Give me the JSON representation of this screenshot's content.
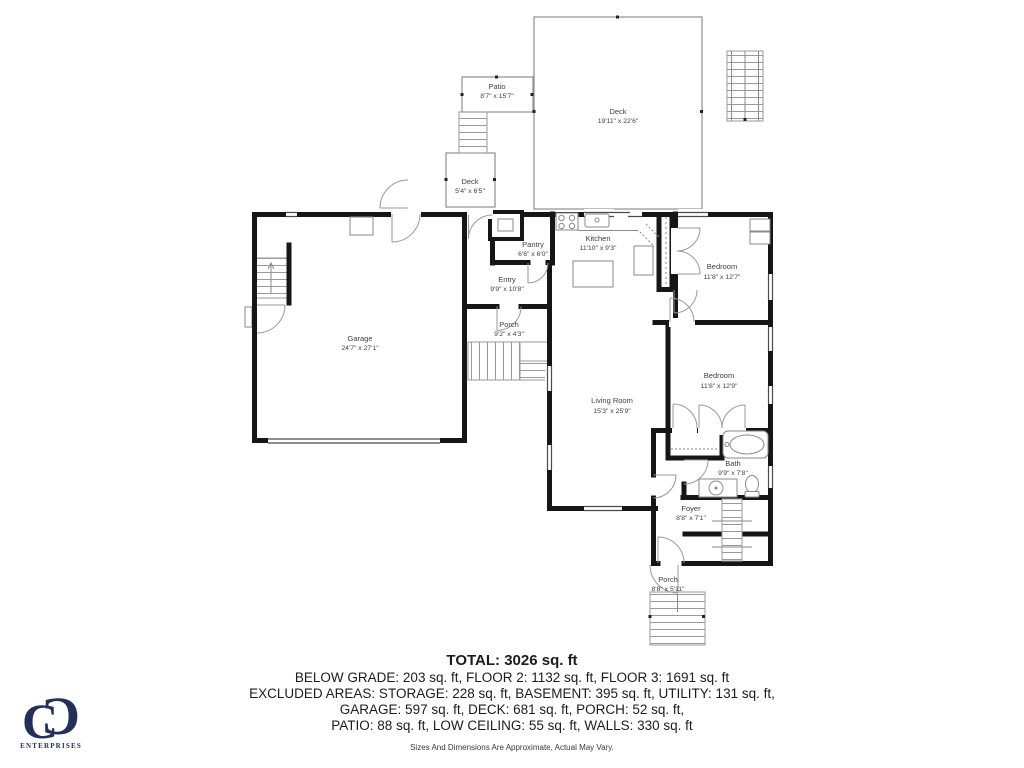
{
  "branding": {
    "monogram_letter": "C",
    "company": "ENTERPRISES",
    "color": "#22305a"
  },
  "floorplan": {
    "wall_color": "#161616",
    "thin_color": "#8f8f8f",
    "label_color": "#3f3f3f",
    "rooms": [
      {
        "name": "Patio",
        "dims": "8'7\" x 15'7\""
      },
      {
        "name": "Deck",
        "dims": "19'11\" x 22'6\""
      },
      {
        "name": "Deck",
        "dims": "5'4\" x 6'5\""
      },
      {
        "name": "Pantry",
        "dims": "6'6\" x 6'0\""
      },
      {
        "name": "Kitchen",
        "dims": "11'10\" x 9'3\""
      },
      {
        "name": "Entry",
        "dims": "9'9\" x 10'8\""
      },
      {
        "name": "Porch",
        "dims": "9'2\" x 4'3\""
      },
      {
        "name": "Garage",
        "dims": "24'7\" x 27'1\""
      },
      {
        "name": "Bedroom",
        "dims": "11'8\" x 12'7\""
      },
      {
        "name": "Bedroom",
        "dims": "11'8\" x 12'9\""
      },
      {
        "name": "Living Room",
        "dims": "15'3\" x 25'9\""
      },
      {
        "name": "Bath",
        "dims": "9'9\" x 7'8\""
      },
      {
        "name": "Foyer",
        "dims": "8'8\" x 7'1\""
      },
      {
        "name": "Porch",
        "dims": "8'8\" x 5'11\""
      }
    ]
  },
  "summary": {
    "total": "TOTAL: 3026 sq. ft",
    "line1": "BELOW GRADE: 203 sq. ft, FLOOR 2: 1132 sq. ft, FLOOR 3: 1691 sq. ft",
    "line2": "EXCLUDED AREAS: STORAGE: 228 sq. ft, BASEMENT: 395 sq. ft, UTILITY: 131 sq. ft,",
    "line3": "GARAGE: 597 sq. ft, DECK: 681 sq. ft, PORCH: 52 sq. ft,",
    "line4": "PATIO: 88 sq. ft, LOW CEILING: 55 sq. ft, WALLS: 330 sq. ft",
    "disclaimer": "Sizes And Dimensions Are Approximate, Actual May Vary."
  }
}
